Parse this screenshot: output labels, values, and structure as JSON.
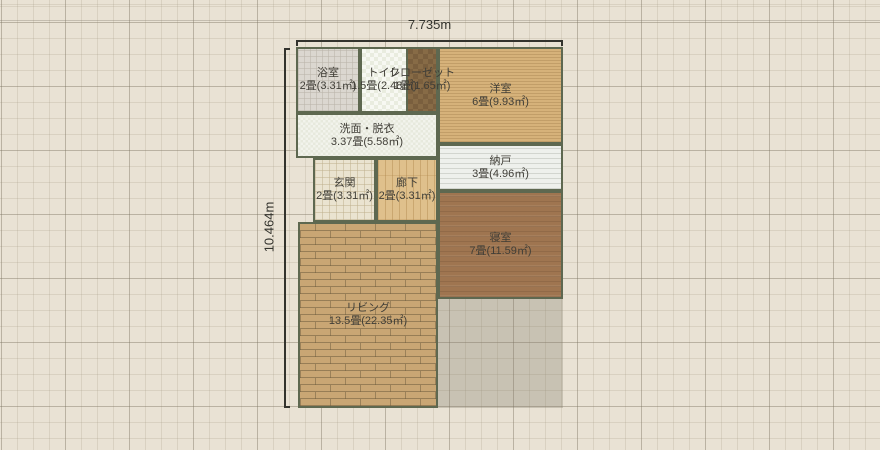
{
  "dimensions": {
    "width_label": "7.735m",
    "height_label": "10.464m"
  },
  "rooms": [
    {
      "key": "bathroom",
      "name": "浴室",
      "size": "2畳(3.31㎡)"
    },
    {
      "key": "toilet",
      "name": "トイレ",
      "size": "1.5畳(2.48㎡)"
    },
    {
      "key": "closet",
      "name": "クローゼット",
      "size": "1畳(1.65㎡)"
    },
    {
      "key": "western-room",
      "name": "洋室",
      "size": "6畳(9.93㎡)"
    },
    {
      "key": "washroom",
      "name": "洗面・脱衣",
      "size": "3.37畳(5.58㎡)"
    },
    {
      "key": "storage-room",
      "name": "納戸",
      "size": "3畳(4.96㎡)"
    },
    {
      "key": "entrance",
      "name": "玄関",
      "size": "2畳(3.31㎡)"
    },
    {
      "key": "hallway",
      "name": "廊下",
      "size": "2畳(3.31㎡)"
    },
    {
      "key": "bedroom",
      "name": "寝室",
      "size": "7畳(11.59㎡)"
    },
    {
      "key": "living",
      "name": "リビング",
      "size": "13.5畳(22.35㎡)"
    }
  ],
  "palette": {
    "canvas_background": "#e9e2d4",
    "grid_major": "#a9a191",
    "grid_minor": "#d8d1c0",
    "wall": "#5e6850",
    "dimension_text": "#33332d",
    "label_text": "#403e37",
    "bathroom_floor": "#dbd7d0",
    "toilet_floor": "#f7f8f2",
    "closet_floor": "#876b46",
    "western_room_floor": "#d6b27a",
    "washroom_floor": "#f2f3ec",
    "storage_floor": "#eef0ec",
    "entrance_floor": "#eae3d0",
    "hallway_floor": "#dfc08c",
    "bedroom_floor": "#9f7550",
    "living_floor": "#c9a674",
    "footprint_shade": "#d7d3c6"
  }
}
